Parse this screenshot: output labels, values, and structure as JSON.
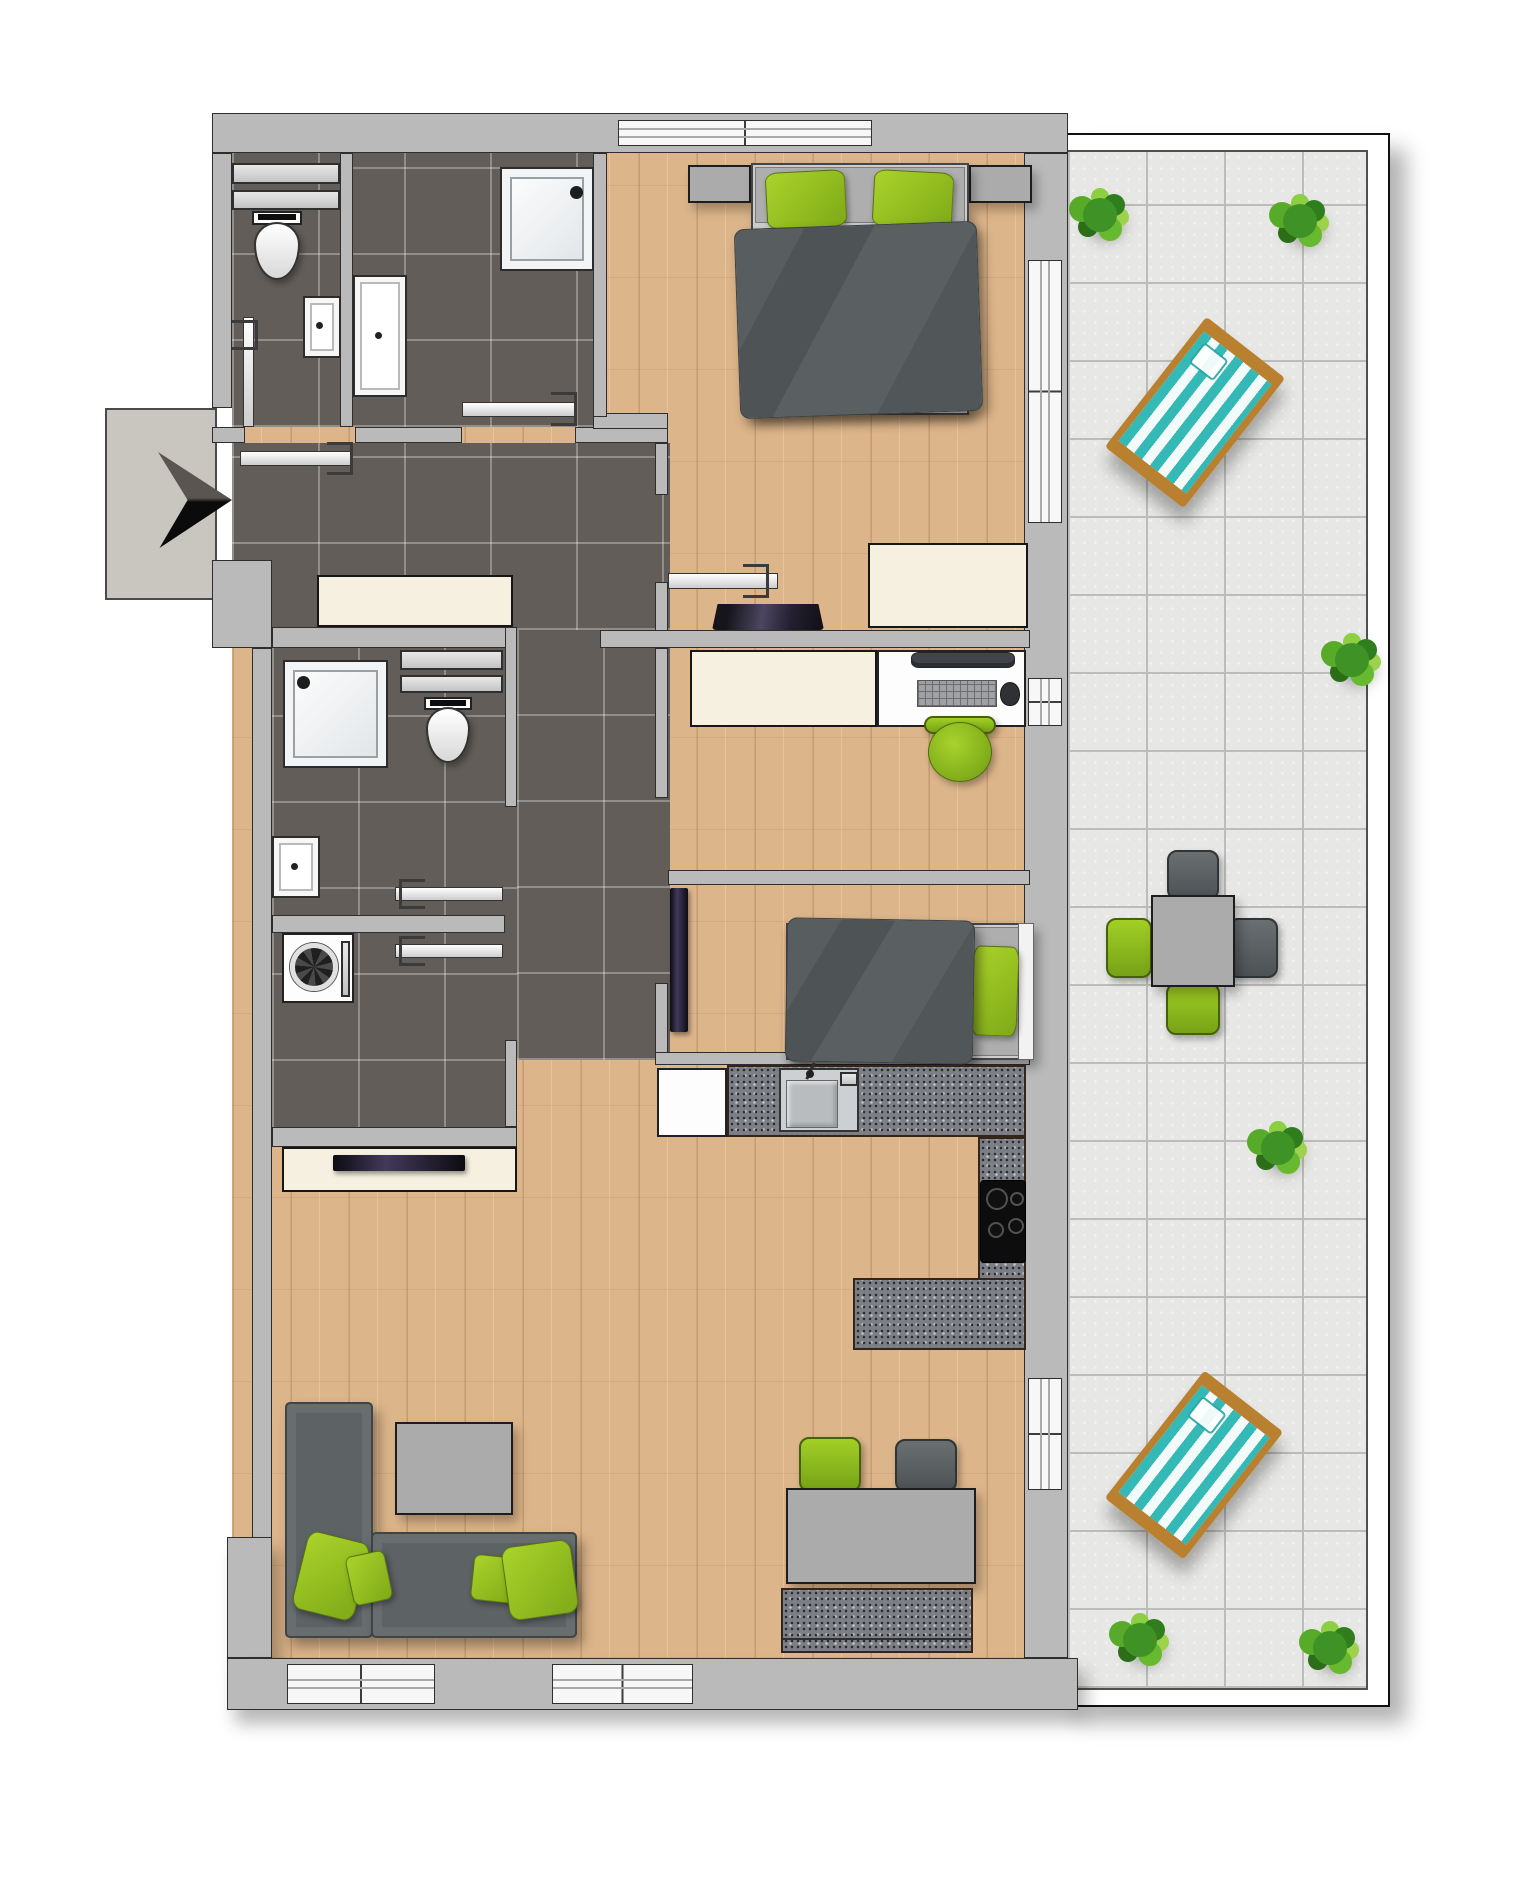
{
  "meta": {
    "title": "apartment-floor-plan-3d-top-view",
    "canvas_w": 1538,
    "canvas_h": 1888
  },
  "colors": {
    "wall": "#bababa",
    "wall_outline": "#2e2e2e",
    "wood_floor": "#ddb58a",
    "dark_tile": "#625d58",
    "terrace_tile": "#e7e7e5",
    "accent_green": "#8fbf1f",
    "fabric_gray": "#5d6265",
    "cream_furniture": "#f5f0df",
    "granite": "#7d7f86",
    "deckchair_teal": "#35b9b7",
    "entrance_landing": "#c9c5bf"
  },
  "elements": [
    {
      "n": "wood-floor",
      "c": "wood",
      "x": 232,
      "y": 133,
      "w": 798,
      "h": 1525
    },
    {
      "n": "terrace-frame",
      "c": "terrace-frame",
      "x": 1066,
      "y": 133,
      "w": 324,
      "h": 1574
    },
    {
      "n": "terrace-tiles",
      "c": "tile-light",
      "x": 1066,
      "y": 150,
      "w": 302,
      "h": 1540
    },
    {
      "n": "tiles-wc-bath",
      "c": "tile-dark",
      "x": 232,
      "y": 153,
      "w": 361,
      "h": 274
    },
    {
      "n": "tiles-hall",
      "c": "tile-dark",
      "x": 232,
      "y": 443,
      "w": 438,
      "h": 187
    },
    {
      "n": "tiles-bath2-laundry",
      "c": "tile-dark",
      "x": 272,
      "y": 627,
      "w": 245,
      "h": 520
    },
    {
      "n": "tiles-corridor",
      "c": "tile-dark",
      "x": 517,
      "y": 630,
      "w": 153,
      "h": 430
    },
    {
      "n": "entrance-landing",
      "c": "landing",
      "x": 105,
      "y": 408,
      "w": 112,
      "h": 192
    },
    {
      "n": "plant-terrace-top-left",
      "c": "plant",
      "x": 1083,
      "y": 198,
      "w": 34,
      "h": 34
    },
    {
      "n": "plant-terrace-top-right",
      "c": "plant",
      "x": 1283,
      "y": 204,
      "w": 34,
      "h": 34
    },
    {
      "n": "plant-terrace-mid-right",
      "c": "plant",
      "x": 1335,
      "y": 643,
      "w": 34,
      "h": 34
    },
    {
      "n": "plant-terrace-lower-right",
      "c": "plant",
      "x": 1261,
      "y": 1131,
      "w": 34,
      "h": 34
    },
    {
      "n": "plant-terrace-bottom-left",
      "c": "plant",
      "x": 1123,
      "y": 1623,
      "w": 34,
      "h": 34
    },
    {
      "n": "plant-terrace-bottom-right",
      "c": "plant",
      "x": 1313,
      "y": 1631,
      "w": 34,
      "h": 34
    },
    {
      "n": "deckchair-upper",
      "c": "deckchair",
      "x": 1145,
      "y": 330,
      "w": 100,
      "h": 165,
      "r": 38
    },
    {
      "n": "deckchair-lower",
      "c": "deckchair",
      "x": 1144,
      "y": 1384,
      "w": 100,
      "h": 162,
      "r": 38
    },
    {
      "n": "terrace-chair-top",
      "c": "chair-dark",
      "x": 1167,
      "y": 850,
      "w": 52,
      "h": 50
    },
    {
      "n": "terrace-chair-right",
      "c": "chair-dark",
      "x": 1228,
      "y": 918,
      "w": 50,
      "h": 60
    },
    {
      "n": "terrace-chair-left",
      "c": "chair-green2",
      "x": 1106,
      "y": 918,
      "w": 46,
      "h": 60
    },
    {
      "n": "terrace-chair-bottom",
      "c": "chair-green2",
      "x": 1166,
      "y": 983,
      "w": 54,
      "h": 52
    },
    {
      "n": "terrace-table",
      "c": "gray-box",
      "x": 1151,
      "y": 895,
      "w": 84,
      "h": 92
    },
    {
      "n": "wall-top",
      "c": "wall",
      "x": 212,
      "y": 113,
      "w": 856,
      "h": 40
    },
    {
      "n": "wall-left-upper",
      "c": "wall",
      "x": 212,
      "y": 153,
      "w": 20,
      "h": 255
    },
    {
      "n": "wall-entrance-block",
      "c": "wall",
      "x": 212,
      "y": 560,
      "w": 60,
      "h": 88
    },
    {
      "n": "wall-left-main",
      "c": "wall",
      "x": 252,
      "y": 648,
      "w": 20,
      "h": 1010
    },
    {
      "n": "wall-left-pillar",
      "c": "wall wall-sh",
      "x": 227,
      "y": 1537,
      "w": 45,
      "h": 121
    },
    {
      "n": "wall-bottom",
      "c": "wall wall-sh",
      "x": 227,
      "y": 1658,
      "w": 851,
      "h": 52
    },
    {
      "n": "wall-right",
      "c": "wall",
      "x": 1024,
      "y": 153,
      "w": 44,
      "h": 1505
    },
    {
      "n": "wall-wc-bath-divider",
      "c": "wall",
      "x": 340,
      "y": 153,
      "w": 13,
      "h": 274
    },
    {
      "n": "wall-under-wc-left",
      "c": "wall",
      "x": 212,
      "y": 427,
      "w": 33,
      "h": 16
    },
    {
      "n": "wall-under-wc-right",
      "c": "wall",
      "x": 355,
      "y": 427,
      "w": 107,
      "h": 16
    },
    {
      "n": "wall-under-bath",
      "c": "wall",
      "x": 575,
      "y": 427,
      "w": 93,
      "h": 16
    },
    {
      "n": "wall-bath-bed-jog",
      "c": "wall",
      "x": 593,
      "y": 413,
      "w": 75,
      "h": 16
    },
    {
      "n": "wall-bath-bed-divider",
      "c": "wall",
      "x": 593,
      "y": 153,
      "w": 14,
      "h": 264
    },
    {
      "n": "wall-bedroom-left-a",
      "c": "wall",
      "x": 655,
      "y": 443,
      "w": 13,
      "h": 52
    },
    {
      "n": "wall-bedroom-left-b",
      "c": "wall",
      "x": 655,
      "y": 582,
      "w": 13,
      "h": 66
    },
    {
      "n": "wall-hall-south",
      "c": "wall",
      "x": 600,
      "y": 630,
      "w": 430,
      "h": 18
    },
    {
      "n": "wall-bath2-top",
      "c": "wall",
      "x": 272,
      "y": 627,
      "w": 241,
      "h": 21
    },
    {
      "n": "wall-bath2-right",
      "c": "wall",
      "x": 505,
      "y": 627,
      "w": 12,
      "h": 180
    },
    {
      "n": "wall-bath2-bottom",
      "c": "wall",
      "x": 272,
      "y": 915,
      "w": 233,
      "h": 18
    },
    {
      "n": "wall-laundry-right",
      "c": "wall",
      "x": 505,
      "y": 1040,
      "w": 12,
      "h": 87
    },
    {
      "n": "wall-laundry-bottom",
      "c": "wall",
      "x": 272,
      "y": 1127,
      "w": 245,
      "h": 20
    },
    {
      "n": "wall-office-left-a",
      "c": "wall",
      "x": 655,
      "y": 648,
      "w": 13,
      "h": 150
    },
    {
      "n": "wall-office-left-b",
      "c": "wall",
      "x": 655,
      "y": 983,
      "w": 13,
      "h": 82
    },
    {
      "n": "wall-office-kids-divider",
      "c": "wall",
      "x": 668,
      "y": 870,
      "w": 362,
      "h": 15
    },
    {
      "n": "wall-kids-bottom",
      "c": "wall",
      "x": 655,
      "y": 1052,
      "w": 375,
      "h": 13
    },
    {
      "n": "window-top-bedroom",
      "c": "win-x",
      "x": 618,
      "y": 120,
      "w": 254,
      "h": 26
    },
    {
      "n": "window-terrace-slider",
      "c": "win-y",
      "x": 1028,
      "y": 260,
      "w": 34,
      "h": 263
    },
    {
      "n": "window-office",
      "c": "win-y",
      "x": 1028,
      "y": 678,
      "w": 34,
      "h": 48
    },
    {
      "n": "window-dining",
      "c": "win-y",
      "x": 1028,
      "y": 1378,
      "w": 34,
      "h": 112
    },
    {
      "n": "window-living-left",
      "c": "win-x",
      "x": 287,
      "y": 1664,
      "w": 148,
      "h": 40
    },
    {
      "n": "window-living-right",
      "c": "win-x",
      "x": 552,
      "y": 1664,
      "w": 141,
      "h": 40
    },
    {
      "n": "door-wc",
      "c": "door",
      "x": 243,
      "y": 317,
      "w": 11,
      "h": 110
    },
    {
      "n": "door-wc-bracket",
      "c": "bracket open-l",
      "x": 232,
      "y": 320,
      "w": 26,
      "h": 30
    },
    {
      "n": "door-bath1",
      "c": "door",
      "x": 462,
      "y": 402,
      "w": 113,
      "h": 15
    },
    {
      "n": "door-bath1-bracket",
      "c": "bracket open-l",
      "x": 551,
      "y": 392,
      "w": 26,
      "h": 34
    },
    {
      "n": "door-entrance",
      "c": "door",
      "x": 240,
      "y": 451,
      "w": 112,
      "h": 15
    },
    {
      "n": "door-entrance-bracket",
      "c": "bracket open-l",
      "x": 327,
      "y": 442,
      "w": 26,
      "h": 33
    },
    {
      "n": "door-bedroom",
      "c": "door",
      "x": 668,
      "y": 573,
      "w": 110,
      "h": 16
    },
    {
      "n": "door-bedroom-bracket",
      "c": "bracket open-l",
      "x": 743,
      "y": 564,
      "w": 26,
      "h": 34
    },
    {
      "n": "door-bath2",
      "c": "door",
      "x": 395,
      "y": 887,
      "w": 108,
      "h": 14
    },
    {
      "n": "door-bath2-bracket",
      "c": "bracket open-r",
      "x": 399,
      "y": 879,
      "w": 26,
      "h": 30
    },
    {
      "n": "door-laundry",
      "c": "door",
      "x": 395,
      "y": 944,
      "w": 108,
      "h": 14
    },
    {
      "n": "door-laundry-bracket",
      "c": "bracket open-r",
      "x": 399,
      "y": 936,
      "w": 26,
      "h": 30
    },
    {
      "n": "entrance-arrow",
      "c": "arrow",
      "x": 158,
      "y": 450,
      "w": 74,
      "h": 100
    },
    {
      "n": "wc-shelf-1",
      "c": "shelf",
      "x": 232,
      "y": 163,
      "w": 108,
      "h": 21
    },
    {
      "n": "wc-shelf-2",
      "c": "shelf",
      "x": 232,
      "y": 190,
      "w": 108,
      "h": 20
    },
    {
      "n": "wc-toilet-tank",
      "c": "white-fix",
      "x": 252,
      "y": 211,
      "w": 50,
      "h": 14
    },
    {
      "n": "wc-toilet-tank-lid",
      "c": "black",
      "x": 258,
      "y": 214,
      "w": 38,
      "h": 6
    },
    {
      "n": "wc-toilet-bowl",
      "c": "toilet-bowl",
      "x": 254,
      "y": 222,
      "w": 46,
      "h": 58
    },
    {
      "n": "wc-sink",
      "c": "sink",
      "x": 303,
      "y": 296,
      "w": 38,
      "h": 62
    },
    {
      "n": "wc-sink-drain",
      "c": "dot",
      "x": 316,
      "y": 322,
      "w": 7,
      "h": 7
    },
    {
      "n": "bath1-shower",
      "c": "shower",
      "x": 500,
      "y": 167,
      "w": 94,
      "h": 104
    },
    {
      "n": "bath1-shower-drain",
      "c": "drain",
      "x": 570,
      "y": 186,
      "w": 13,
      "h": 13
    },
    {
      "n": "bath1-sink",
      "c": "sink",
      "x": 353,
      "y": 275,
      "w": 54,
      "h": 122
    },
    {
      "n": "bath1-sink-drain",
      "c": "dot",
      "x": 375,
      "y": 332,
      "w": 7,
      "h": 7
    },
    {
      "n": "hall-sideboard",
      "c": "cream",
      "x": 317,
      "y": 575,
      "w": 196,
      "h": 52
    },
    {
      "n": "bath2-shower",
      "c": "shower",
      "x": 283,
      "y": 660,
      "w": 105,
      "h": 108
    },
    {
      "n": "bath2-shower-drain",
      "c": "drain",
      "x": 297,
      "y": 676,
      "w": 13,
      "h": 13
    },
    {
      "n": "bath2-shelf-1",
      "c": "shelf",
      "x": 400,
      "y": 650,
      "w": 103,
      "h": 20
    },
    {
      "n": "bath2-shelf-2",
      "c": "shelf",
      "x": 400,
      "y": 675,
      "w": 103,
      "h": 18
    },
    {
      "n": "bath2-toilet-tank",
      "c": "white-fix",
      "x": 424,
      "y": 697,
      "w": 48,
      "h": 13
    },
    {
      "n": "bath2-toilet-tank-lid",
      "c": "black",
      "x": 430,
      "y": 700,
      "w": 36,
      "h": 6
    },
    {
      "n": "bath2-toilet-bowl",
      "c": "toilet-bowl",
      "x": 426,
      "y": 707,
      "w": 44,
      "h": 56
    },
    {
      "n": "bath2-sink",
      "c": "sink",
      "x": 272,
      "y": 836,
      "w": 48,
      "h": 62
    },
    {
      "n": "bath2-sink-drain",
      "c": "dot",
      "x": 291,
      "y": 863,
      "w": 7,
      "h": 7
    },
    {
      "n": "washing-machine",
      "c": "white-fix",
      "x": 282,
      "y": 933,
      "w": 72,
      "h": 70
    },
    {
      "n": "washing-machine-drum",
      "c": "drum",
      "x": 290,
      "y": 943,
      "w": 48,
      "h": 48
    },
    {
      "n": "washing-machine-panel",
      "c": "shelf",
      "x": 341,
      "y": 941,
      "w": 9,
      "h": 56
    },
    {
      "n": "bed-double-nightstand-left",
      "c": "gray-box",
      "x": 688,
      "y": 165,
      "w": 63,
      "h": 38
    },
    {
      "n": "bed-double-nightstand-right",
      "c": "gray-box",
      "x": 969,
      "y": 165,
      "w": 63,
      "h": 38
    },
    {
      "n": "bed-double-frame",
      "c": "bedframe",
      "x": 751,
      "y": 163,
      "w": 218,
      "h": 252
    },
    {
      "n": "bed-double-mattress",
      "c": "mattress",
      "x": 755,
      "y": 167,
      "w": 210,
      "h": 56
    },
    {
      "n": "bed-double-pillow-left",
      "c": "pillow-green",
      "x": 766,
      "y": 171,
      "w": 80,
      "h": 57,
      "r": -3
    },
    {
      "n": "bed-double-pillow-right",
      "c": "pillow-green",
      "x": 873,
      "y": 171,
      "w": 80,
      "h": 57,
      "r": 3
    },
    {
      "n": "bed-double-duvet",
      "c": "duvet",
      "x": 737,
      "y": 225,
      "w": 243,
      "h": 190,
      "r": -2
    },
    {
      "n": "bedroom-sideboard",
      "c": "cream",
      "x": 868,
      "y": 543,
      "w": 160,
      "h": 85
    },
    {
      "n": "bedroom-laptop",
      "c": "laptop",
      "x": 712,
      "y": 604,
      "w": 112,
      "h": 26
    },
    {
      "n": "office-sideboard",
      "c": "cream",
      "x": 690,
      "y": 650,
      "w": 187,
      "h": 77
    },
    {
      "n": "office-desk",
      "c": "white-fix",
      "x": 877,
      "y": 650,
      "w": 149,
      "h": 77
    },
    {
      "n": "office-monitor",
      "c": "monitor",
      "x": 911,
      "y": 652,
      "w": 104,
      "h": 16
    },
    {
      "n": "office-keyboard",
      "c": "keyboard",
      "x": 917,
      "y": 680,
      "w": 80,
      "h": 27
    },
    {
      "n": "office-mouse",
      "c": "mouse",
      "x": 1000,
      "y": 682,
      "w": 20,
      "h": 24
    },
    {
      "n": "office-chair-back",
      "c": "chair-green2",
      "x": 924,
      "y": 716,
      "w": 72,
      "h": 18
    },
    {
      "n": "office-chair-seat",
      "c": "green-round",
      "x": 928,
      "y": 722,
      "w": 64,
      "h": 60
    },
    {
      "n": "kids-tv",
      "c": "tv",
      "x": 670,
      "y": 888,
      "w": 18,
      "h": 144
    },
    {
      "n": "bed-single-frame",
      "c": "bedframe",
      "x": 786,
      "y": 923,
      "w": 248,
      "h": 137
    },
    {
      "n": "bed-single-mattress",
      "c": "mattress",
      "x": 790,
      "y": 927,
      "w": 240,
      "h": 129
    },
    {
      "n": "bed-single-headboard",
      "c": "headboard",
      "x": 1018,
      "y": 923,
      "w": 16,
      "h": 137
    },
    {
      "n": "bed-single-pillow",
      "c": "pillow-green",
      "x": 972,
      "y": 946,
      "w": 46,
      "h": 90,
      "r": 2
    },
    {
      "n": "bed-single-duvet",
      "c": "duvet",
      "x": 786,
      "y": 919,
      "w": 188,
      "h": 144,
      "r": 1
    },
    {
      "n": "kitchen-fridge",
      "c": "white-fix",
      "x": 657,
      "y": 1068,
      "w": 70,
      "h": 69
    },
    {
      "n": "kitchen-counter-top",
      "c": "granite",
      "x": 727,
      "y": 1065,
      "w": 299,
      "h": 72
    },
    {
      "n": "kitchen-sink-unit",
      "c": "steel",
      "x": 779,
      "y": 1068,
      "w": 80,
      "h": 64
    },
    {
      "n": "kitchen-sink-basin",
      "c": "steel-basin",
      "x": 786,
      "y": 1080,
      "w": 52,
      "h": 48
    },
    {
      "n": "kitchen-faucet-arm",
      "c": "blackline",
      "x": 809,
      "y": 1062,
      "w": 3,
      "h": 18,
      "r": 25
    },
    {
      "n": "kitchen-faucet-base",
      "c": "dot",
      "x": 806,
      "y": 1070,
      "w": 8,
      "h": 8
    },
    {
      "n": "kitchen-soap-dish",
      "c": "shelf",
      "x": 840,
      "y": 1072,
      "w": 18,
      "h": 14
    },
    {
      "n": "kitchen-counter-right",
      "c": "granite",
      "x": 978,
      "y": 1137,
      "w": 48,
      "h": 213
    },
    {
      "n": "kitchen-hob",
      "c": "hob",
      "x": 980,
      "y": 1180,
      "w": 46,
      "h": 83
    },
    {
      "n": "hob-burner-1",
      "c": "burner",
      "x": 986,
      "y": 1188,
      "w": 22,
      "h": 22
    },
    {
      "n": "hob-burner-2",
      "c": "burner",
      "x": 1010,
      "y": 1192,
      "w": 14,
      "h": 14
    },
    {
      "n": "hob-burner-3",
      "c": "burner",
      "x": 988,
      "y": 1222,
      "w": 16,
      "h": 16
    },
    {
      "n": "hob-burner-4",
      "c": "burner",
      "x": 1008,
      "y": 1218,
      "w": 16,
      "h": 16
    },
    {
      "n": "kitchen-peninsula",
      "c": "granite",
      "x": 853,
      "y": 1278,
      "w": 173,
      "h": 72
    },
    {
      "n": "tv-sideboard",
      "c": "cream",
      "x": 282,
      "y": 1147,
      "w": 235,
      "h": 45
    },
    {
      "n": "living-tv",
      "c": "tv",
      "x": 333,
      "y": 1155,
      "w": 132,
      "h": 16
    },
    {
      "n": "sofa-vertical",
      "c": "sofa",
      "x": 285,
      "y": 1402,
      "w": 88,
      "h": 236
    },
    {
      "n": "sofa-horizontal",
      "c": "sofa",
      "x": 371,
      "y": 1532,
      "w": 206,
      "h": 106
    },
    {
      "n": "sofa-pillow-1",
      "c": "pillow-green",
      "x": 299,
      "y": 1536,
      "w": 64,
      "h": 80,
      "r": 14
    },
    {
      "n": "sofa-pillow-2",
      "c": "pillow-green",
      "x": 349,
      "y": 1553,
      "w": 40,
      "h": 50,
      "r": -12
    },
    {
      "n": "sofa-pillow-3",
      "c": "pillow-green",
      "x": 472,
      "y": 1556,
      "w": 48,
      "h": 46,
      "r": 6
    },
    {
      "n": "sofa-pillow-4",
      "c": "pillow-green",
      "x": 505,
      "y": 1543,
      "w": 70,
      "h": 74,
      "r": -8
    },
    {
      "n": "coffee-table",
      "c": "gray-box",
      "x": 395,
      "y": 1422,
      "w": 118,
      "h": 93
    },
    {
      "n": "dining-chair-green",
      "c": "chair-green2",
      "x": 799,
      "y": 1437,
      "w": 62,
      "h": 55
    },
    {
      "n": "dining-chair-gray",
      "c": "chair-dark",
      "x": 895,
      "y": 1439,
      "w": 62,
      "h": 53
    },
    {
      "n": "dining-table",
      "c": "gray-box",
      "x": 786,
      "y": 1488,
      "w": 190,
      "h": 96
    },
    {
      "n": "dining-bench",
      "c": "granite",
      "x": 781,
      "y": 1588,
      "w": 192,
      "h": 65
    },
    {
      "n": "dining-bench-line",
      "c": "blackline",
      "x": 783,
      "y": 1638,
      "w": 188,
      "h": 2
    }
  ]
}
